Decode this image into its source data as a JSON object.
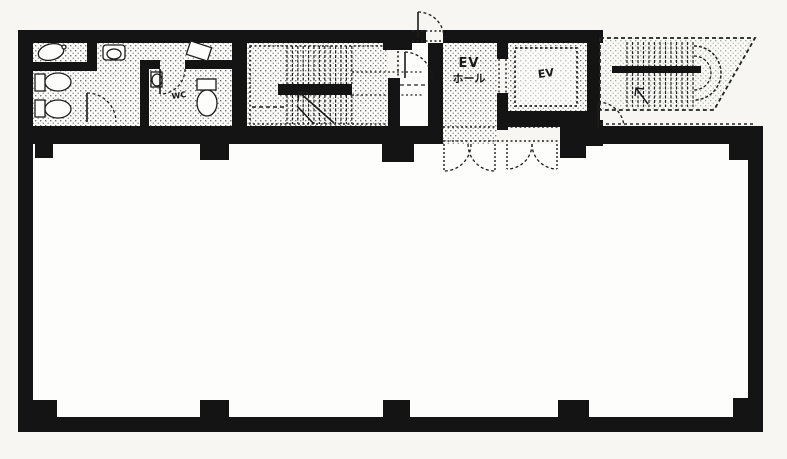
{
  "labels": {
    "ev_hall_line1": "EV",
    "ev_hall_line2": "ホール",
    "elevator": "EV",
    "toilet": "WC"
  },
  "colors": {
    "wall": "#141414",
    "ink": "#1a1a1a",
    "paper": "#f7f6f2",
    "room": "#fdfdfb",
    "stipple_dot": "#5a5a58"
  }
}
